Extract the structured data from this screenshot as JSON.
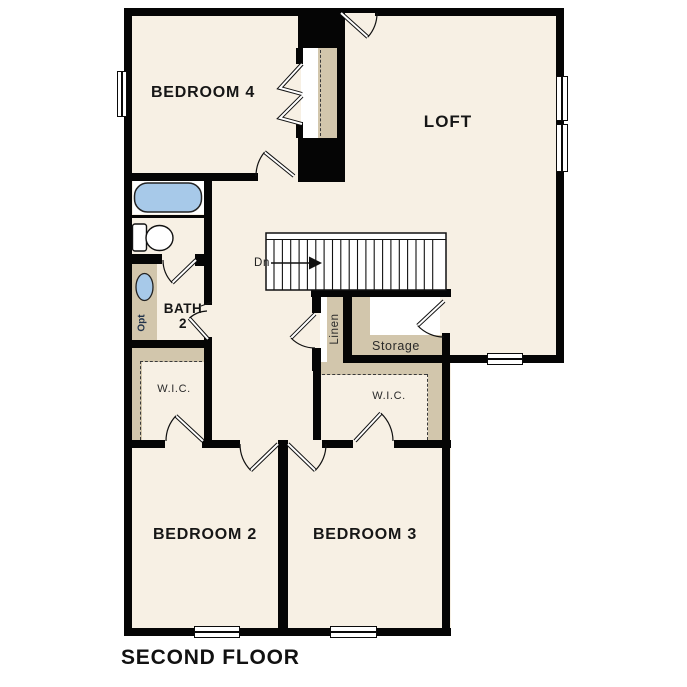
{
  "title": "SECOND FLOOR",
  "labels": {
    "bedroom4": "BEDROOM 4",
    "loft": "LOFT",
    "bath_line1": "BATH",
    "bath_line2": "2",
    "wic_left": "W.I.C.",
    "wic_right": "W.I.C.",
    "linen": "Linen",
    "storage": "Storage",
    "stairs_direction": "Dn",
    "sink_option": "Opt",
    "bedroom2": "BEDROOM 2",
    "bedroom3": "BEDROOM 3"
  },
  "colors": {
    "floor": "#f7f0e4",
    "wall": "#050505",
    "casework": "#d2c6ac",
    "plumbing_fixture_blue": "#a7c9e9"
  }
}
